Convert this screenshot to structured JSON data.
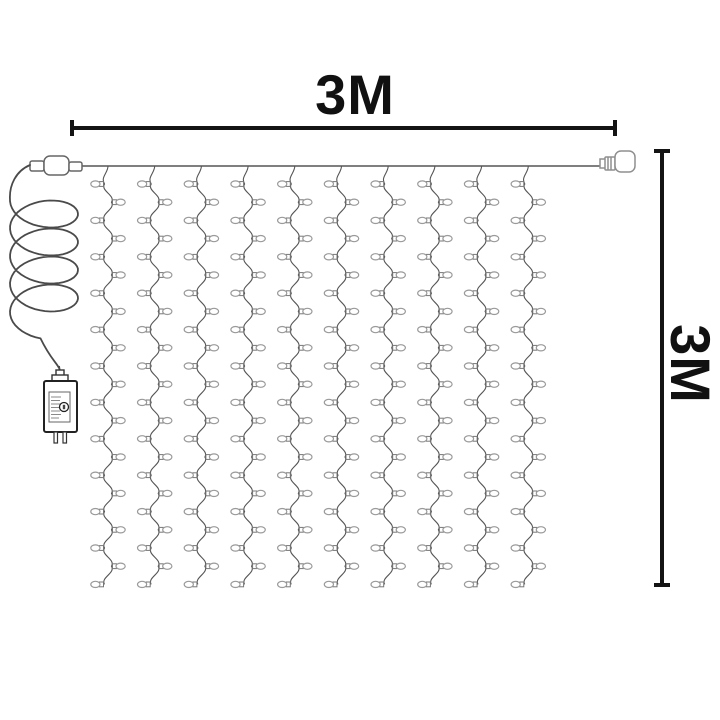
{
  "product": {
    "title": "curtain-string-lights-dimension-diagram",
    "dimensions": {
      "width_label": "3M",
      "height_label": "3M"
    },
    "curtain": {
      "strand_count": 10,
      "bulbs_per_strand": 23
    },
    "parts": {
      "left_connector": "cable-coupler-connector",
      "right_connector": "end-plug-connector",
      "power_adapter": "power-adapter-plug",
      "cable": "coiled-power-cable",
      "top_wire": "main-horizontal-wire"
    },
    "colors": {
      "dimension": "#141414",
      "wire": "#555555",
      "bulb_outline": "#9a9a9a",
      "socket_outline": "#777777",
      "connector_outline": "#8f8f8f",
      "background": "#ffffff"
    }
  }
}
